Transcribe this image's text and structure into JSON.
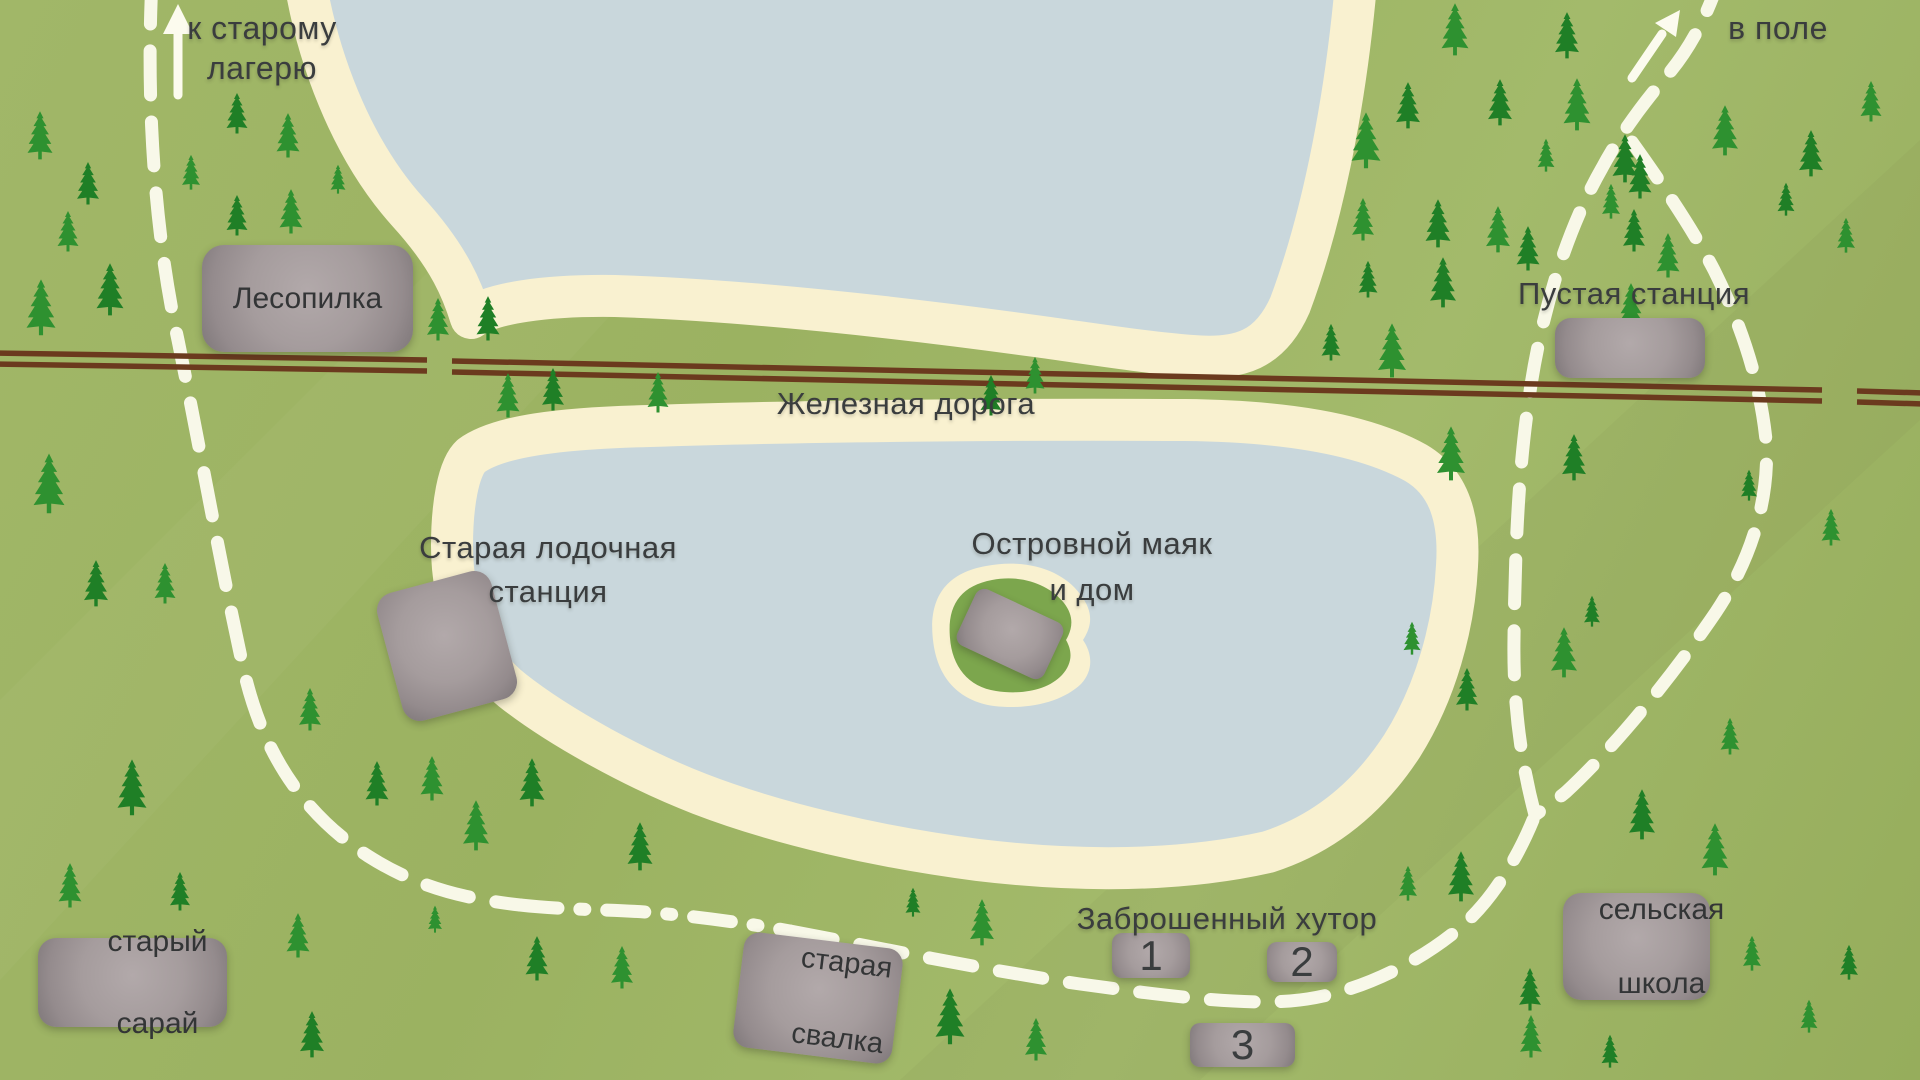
{
  "map_title": "Hand-drawn forest lake map",
  "labels": {
    "to_old_camp_line1": "к старому",
    "to_old_camp_line2": "лагерю",
    "to_field": "в поле",
    "railway": "Железная дорога",
    "sawmill": "Лесопилка",
    "empty_station": "Пустая станция",
    "old_boat_station_line1": "Старая лодочная",
    "old_boat_station_line2": "станция",
    "island_lighthouse_line1": "Островной маяк",
    "island_lighthouse_line2": "и дом",
    "abandoned_farmstead": "Заброшенный хутор",
    "farm_building_1": "1",
    "farm_building_2": "2",
    "farm_building_3": "3",
    "old_barn_line1": "старый",
    "old_barn_line2": "сарай",
    "old_dump_line1": "старая",
    "old_dump_line2": "свалка",
    "village_school_line1": "сельская",
    "village_school_line2": "школа"
  },
  "colors": {
    "grass": "#9db463",
    "water": "#c9d7dc",
    "beach": "#f9f1d0",
    "island_green": "#7ca64d",
    "rail_brown": "#6b3a1e",
    "path_white": "#fcfbee",
    "tree_green_bright": "#2e9130",
    "tree_green_dark": "#1f7f26",
    "building_gray": "#a59c9d",
    "text": "#3a3d3e"
  },
  "trees": [
    [
      40,
      160,
      50,
      "a"
    ],
    [
      88,
      205,
      44,
      "b"
    ],
    [
      68,
      252,
      42,
      "a"
    ],
    [
      110,
      316,
      54,
      "b"
    ],
    [
      41,
      336,
      58,
      "a"
    ],
    [
      191,
      190,
      36,
      "a"
    ],
    [
      237,
      134,
      42,
      "b"
    ],
    [
      288,
      158,
      46,
      "a"
    ],
    [
      237,
      236,
      42,
      "b"
    ],
    [
      291,
      234,
      46,
      "a"
    ],
    [
      338,
      194,
      30,
      "a"
    ],
    [
      363,
      334,
      50,
      "b"
    ],
    [
      438,
      341,
      44,
      "a"
    ],
    [
      488,
      341,
      46,
      "b"
    ],
    [
      508,
      418,
      46,
      "a"
    ],
    [
      553,
      411,
      44,
      "b"
    ],
    [
      658,
      413,
      42,
      "a"
    ],
    [
      991,
      416,
      42,
      "b"
    ],
    [
      1035,
      394,
      38,
      "a"
    ],
    [
      49,
      514,
      62,
      "a"
    ],
    [
      96,
      607,
      48,
      "b"
    ],
    [
      165,
      604,
      42,
      "a"
    ],
    [
      132,
      816,
      58,
      "b"
    ],
    [
      70,
      908,
      46,
      "a"
    ],
    [
      180,
      911,
      40,
      "b"
    ],
    [
      298,
      958,
      46,
      "a"
    ],
    [
      312,
      1058,
      48,
      "b"
    ],
    [
      310,
      731,
      44,
      "a"
    ],
    [
      377,
      806,
      46,
      "b"
    ],
    [
      432,
      801,
      46,
      "a"
    ],
    [
      532,
      807,
      50,
      "b"
    ],
    [
      476,
      851,
      52,
      "a"
    ],
    [
      640,
      871,
      50,
      "b"
    ],
    [
      435,
      933,
      28,
      "a"
    ],
    [
      537,
      981,
      46,
      "b"
    ],
    [
      622,
      989,
      44,
      "a"
    ],
    [
      982,
      946,
      48,
      "a"
    ],
    [
      950,
      1045,
      58,
      "b"
    ],
    [
      1036,
      1061,
      44,
      "a"
    ],
    [
      913,
      917,
      30,
      "b"
    ],
    [
      1408,
      901,
      36,
      "a"
    ],
    [
      1455,
      56,
      54,
      "a"
    ],
    [
      1408,
      129,
      48,
      "b"
    ],
    [
      1366,
      169,
      58,
      "a"
    ],
    [
      1567,
      59,
      48,
      "b"
    ],
    [
      1577,
      131,
      54,
      "a"
    ],
    [
      1500,
      126,
      48,
      "b"
    ],
    [
      1546,
      172,
      34,
      "a"
    ],
    [
      1640,
      199,
      46,
      "b"
    ],
    [
      1725,
      156,
      52,
      "a"
    ],
    [
      1811,
      177,
      48,
      "b"
    ],
    [
      1871,
      122,
      42,
      "a"
    ],
    [
      1625,
      183,
      50,
      "b"
    ],
    [
      1363,
      241,
      44,
      "a"
    ],
    [
      1438,
      248,
      50,
      "b"
    ],
    [
      1498,
      253,
      48,
      "a"
    ],
    [
      1634,
      252,
      44,
      "b"
    ],
    [
      1668,
      278,
      46,
      "a"
    ],
    [
      1786,
      216,
      34,
      "b"
    ],
    [
      1846,
      253,
      36,
      "a"
    ],
    [
      1528,
      271,
      46,
      "b"
    ],
    [
      1611,
      219,
      36,
      "a"
    ],
    [
      1443,
      308,
      52,
      "b"
    ],
    [
      1392,
      378,
      56,
      "a"
    ],
    [
      1368,
      298,
      38,
      "b"
    ],
    [
      1631,
      328,
      46,
      "a"
    ],
    [
      1331,
      361,
      38,
      "b"
    ],
    [
      1451,
      481,
      56,
      "a"
    ],
    [
      1574,
      481,
      48,
      "b"
    ],
    [
      1831,
      546,
      38,
      "a"
    ],
    [
      1749,
      501,
      32,
      "b"
    ],
    [
      1412,
      655,
      34,
      "a"
    ],
    [
      1467,
      711,
      44,
      "b"
    ],
    [
      1564,
      678,
      52,
      "a"
    ],
    [
      1592,
      627,
      32,
      "b"
    ],
    [
      1730,
      755,
      38,
      "a"
    ],
    [
      1642,
      840,
      52,
      "b"
    ],
    [
      1715,
      876,
      54,
      "a"
    ],
    [
      1461,
      902,
      52,
      "b"
    ],
    [
      1752,
      971,
      36,
      "a"
    ],
    [
      1849,
      980,
      36,
      "b"
    ],
    [
      1809,
      1033,
      34,
      "a"
    ],
    [
      1530,
      1011,
      44,
      "b"
    ],
    [
      1531,
      1058,
      44,
      "a"
    ],
    [
      1610,
      1068,
      34,
      "b"
    ]
  ]
}
